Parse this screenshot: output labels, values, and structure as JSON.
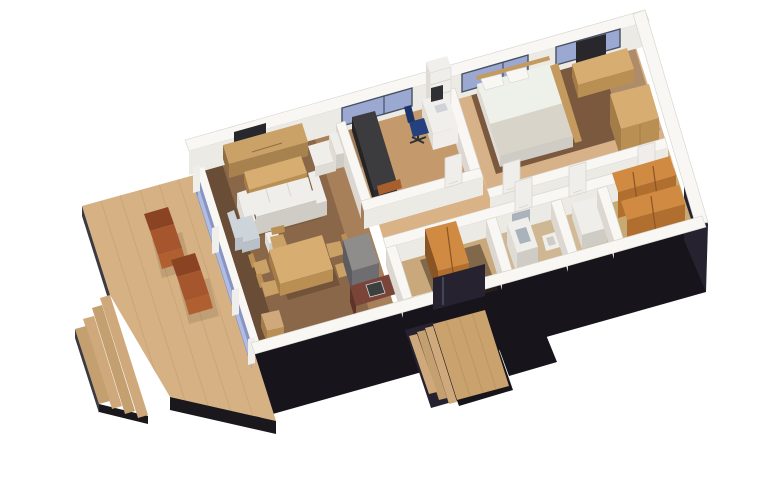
{
  "scene": {
    "type": "isometric-3d-floor-plan-render",
    "view": "axonometric cutaway seen from above / south-west",
    "background": "#ffffff",
    "objects": [
      "wooden terrace deck with two brown sun loungers",
      "deck stairs (four treads) on lower-left edge",
      "glazed facade between deck and living room",
      "living room: wood tv cabinet, wall tv, coffee table, cream sofa, cream armchair, blue-grey armchair, side cube",
      "dining area: wood table with five chairs",
      "kitchen: grey tall unit, dark red-brown counter with sink, beige stool block",
      "office: dark daybed, white desk with monitor and laptop, blue swivel chair, white shelf unit",
      "master bedroom: double bed with pillows, dark brown rug, wood sideboard, wall tv, wood wardrobe",
      "bathroom: white vanity with basin, toilet, mirror",
      "second bathroom: white fixture",
      "walk-in closet: two orange-wood wardrobe rows",
      "entry hall: orange-wood open closet, dark glass entrance door",
      "entrance: wooden stair platform with three treads and dark flanking walls",
      "three blue windows along the top facade",
      "white interior partition walls with panelled doors",
      "black plinth facade along bottom and right"
    ]
  },
  "palette": {
    "wall_top": "#f8f7f4",
    "wall_face": "#eceae4",
    "wall_shade": "#dcd8d1",
    "wall_stroke": "#d6d2ca",
    "glass_blue": "#9aa8d2",
    "glass_blue_light": "#bac6e8",
    "glass_frame": "#475061",
    "facade_glass": "#8795c4",
    "base_black": "#17151b",
    "base_black2": "#262230",
    "deck_wood": "#d6b184",
    "deck_plank": "#bf9d6d",
    "deck_step_a": "#cfa97b",
    "deck_step_b": "#c4a070",
    "deck_edge": "#3c3a40",
    "deck_edge_dark": "#1a181d",
    "lounger_dark": "#8a4423",
    "lounger_mid": "#a5562c",
    "lounger_light": "#b06030",
    "floor_living": "#8a6748",
    "floor_living_dark": "#3a281c",
    "floor_living_light": "#c09468",
    "floor_office": "#c49a6c",
    "floor_corridor": "#d9b286",
    "floor_entry": "#c9a97b",
    "floor_bath": "#cfb794",
    "floor_bath2": "#d3ba96",
    "floor_closet": "#c8a873",
    "floor_bedroom": "#d7b187",
    "rug_brown": "#6b4a31",
    "shadow_brown": "#503823",
    "wood_mid": "#caa268",
    "wood_mid_side": "#a8824e",
    "wood_mid_dark": "#8f6d40",
    "wood_light": "#d7ad72",
    "wood_light_side": "#b98f54",
    "wood_light_dark": "#a37c48",
    "tv_dark": "#28282c",
    "white_top": "#efeeea",
    "white_side": "#dfdcd5",
    "white_dark": "#cfccc5",
    "fabric_blue_top": "#cdd4da",
    "fabric_blue_side": "#b9c0c7",
    "daybed_top": "#3c3b3e",
    "daybed_side": "#2c2b2e",
    "daybed_dark": "#242326",
    "daybed_foot": "#a85f2e",
    "chair_blue": "#24407e",
    "chair_blue_dark": "#1c3468",
    "desk_white": "#f0efec",
    "screen_dark": "#2e3034",
    "laptop_gray": "#cfd3d8",
    "kitchen_gray": "#8e8d8b",
    "kitchen_gray_side": "#6e6d71",
    "kitchen_gray_dark": "#5c5b60",
    "counter_red": "#7a4538",
    "counter_red_side": "#5e3328",
    "sink_dark": "#3b3f3e",
    "orange_top": "#d08a42",
    "orange_side": "#b06f2e",
    "orange_dark": "#8a5524",
    "bed_white": "#eef0ea",
    "bed_throw": "#d8d4c9",
    "bed_wood": "#c49a5e",
    "mirror_gray": "#aab2bb",
    "steps_wood": "#c9a26e",
    "steps_wood_dark": "#b8905c",
    "seam_light": "#d8d5ce"
  }
}
